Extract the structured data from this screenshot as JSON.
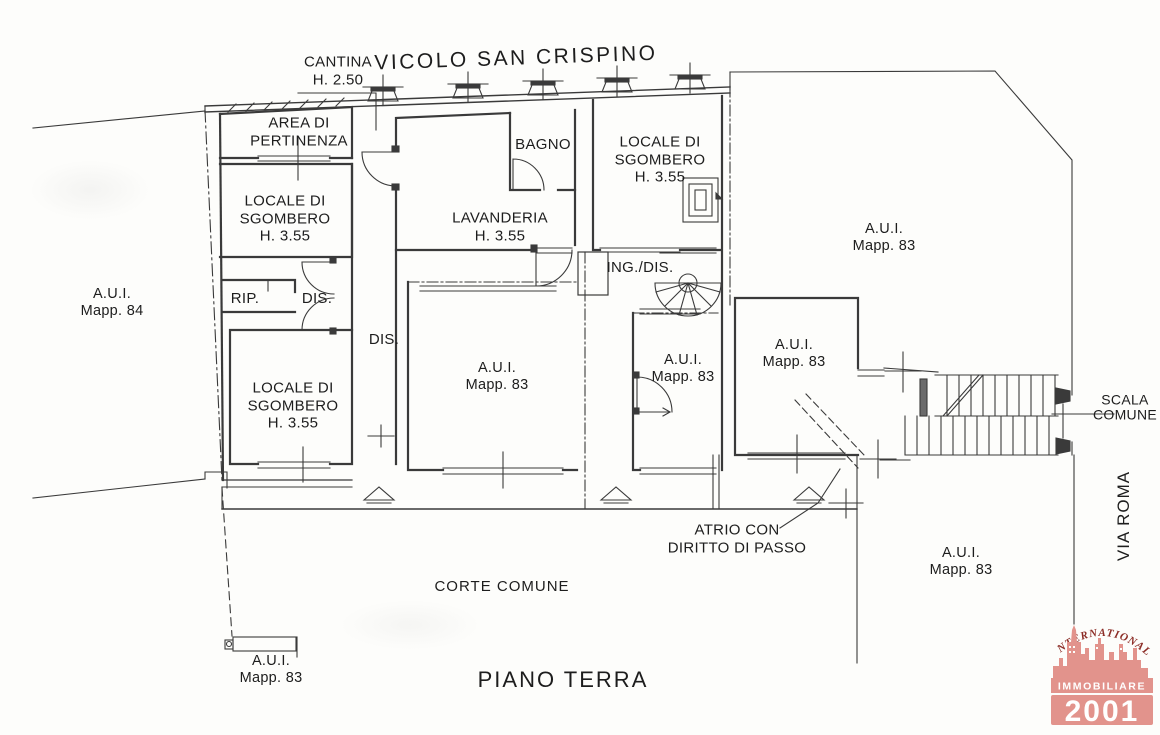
{
  "street_top": "VICOLO SAN CRISPINO",
  "street_right": "VIA ROMA",
  "floor_label": "PIANO TERRA",
  "corte_label": "CORTE COMUNE",
  "cantina": {
    "l1": "CANTINA",
    "l2": "H. 2.50"
  },
  "atrio": {
    "l1": "ATRIO CON",
    "l2": "DIRITTO DI PASSO"
  },
  "scala": {
    "l1": "SCALA",
    "l2": "COMUNE"
  },
  "rooms": {
    "pertinenza": {
      "l1": "AREA DI",
      "l2": "PERTINENZA"
    },
    "sgombero1": {
      "l1": "LOCALE DI",
      "l2": "SGOMBERO",
      "l3": "H. 3.55"
    },
    "sgombero2": {
      "l1": "LOCALE DI",
      "l2": "SGOMBERO",
      "l3": "H. 3.55"
    },
    "sgombero3": {
      "l1": "LOCALE DI",
      "l2": "SGOMBERO",
      "l3": "H. 3.55"
    },
    "lavanderia": {
      "l1": "LAVANDERIA",
      "l2": "H. 3.55"
    },
    "bagno": "BAGNO",
    "rip": "RIP.",
    "dis1": "DIS.",
    "dis2": "DIS.",
    "ingdis": "ING./DIS."
  },
  "parcels": [
    {
      "l1": "A.U.I.",
      "l2": "Mapp. 84"
    },
    {
      "l1": "A.U.I.",
      "l2": "Mapp. 83"
    },
    {
      "l1": "A.U.I.",
      "l2": "Mapp. 83"
    },
    {
      "l1": "A.U.I.",
      "l2": "Mapp. 83"
    },
    {
      "l1": "A.U.I.",
      "l2": "Mapp. 83"
    },
    {
      "l1": "A.U.I.",
      "l2": "Mapp. 83"
    },
    {
      "l1": "A.U.I.",
      "l2": "Mapp. 83"
    }
  ],
  "logo": {
    "top": "INTERNATIONAL",
    "middle": "IMMOBILIARE",
    "number": "2001"
  },
  "colors": {
    "ink": "#3a3a3a",
    "logo_pink": "#e2938c",
    "logo_red": "#8c2d27",
    "paper": "#fdfdfb"
  }
}
